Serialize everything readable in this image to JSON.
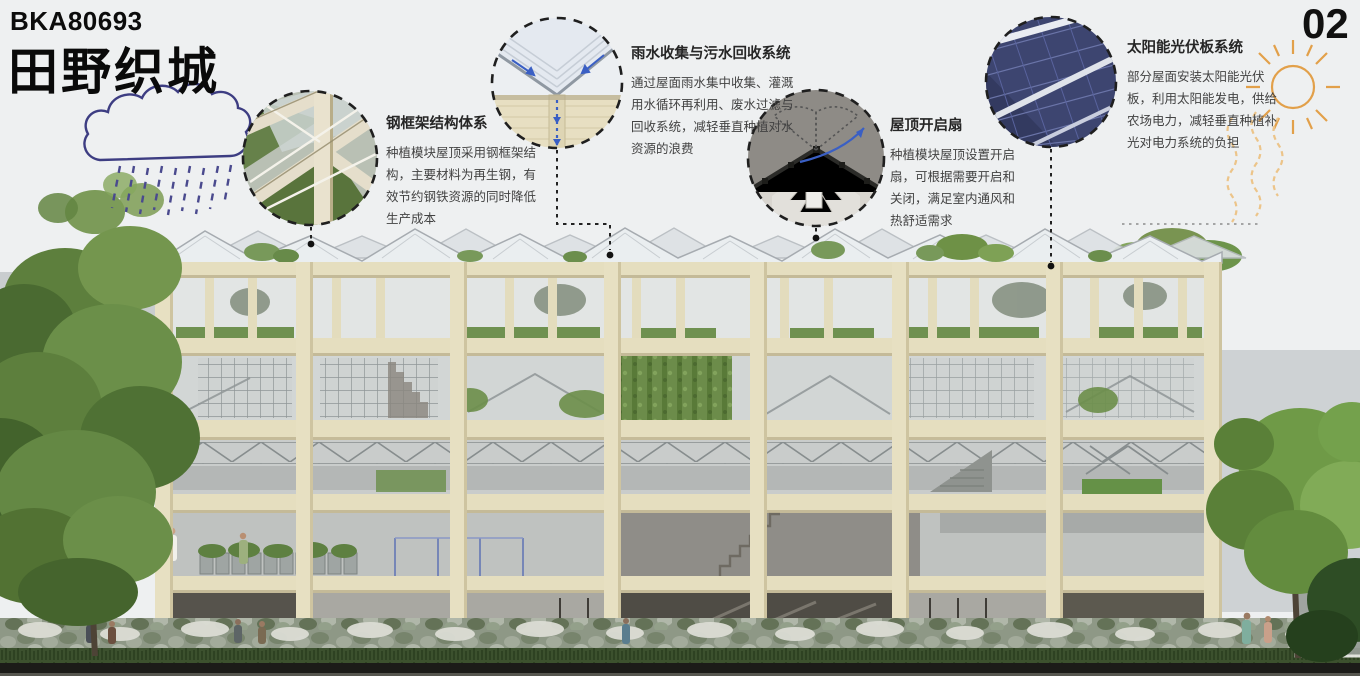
{
  "header": {
    "code": "BKA80693",
    "title": "田野织城",
    "page_number": "02"
  },
  "callouts": [
    {
      "id": "steel-frame",
      "title": "钢框架结构体系",
      "body": "种植模块屋顶采用钢框架结构，主要材料为再生钢，有效节约钢铁资源的同时降低生产成本"
    },
    {
      "id": "rainwater",
      "title": "雨水收集与污水回收系统",
      "body": "通过屋面雨水集中收集、灌溉用水循环再利用、废水过滤与回收系统，减轻垂直种植对水资源的浪费"
    },
    {
      "id": "roof-vent",
      "title": "屋顶开启扇",
      "body": "种植模块屋顶设置开启扇，可根据需要开启和关闭，满足室内通风和热舒适需求"
    },
    {
      "id": "solar",
      "title": "太阳能光伏板系统",
      "body": "部分屋面安装太阳能光伏板，利用太阳能发电，供给农场电力，减轻垂直种植补光对电力系统的负担"
    }
  ],
  "icons": {
    "cloud": "rain-cloud-icon",
    "sun": "sun-icon"
  },
  "colors": {
    "accent_blue": "#3a5fc4",
    "cloud_indigo": "#3d3d82",
    "sun_orange": "#e2a04a",
    "facade_beige": "#e5debf",
    "foliage_green": "#6f9150",
    "solar_navy": "#3d4570"
  }
}
